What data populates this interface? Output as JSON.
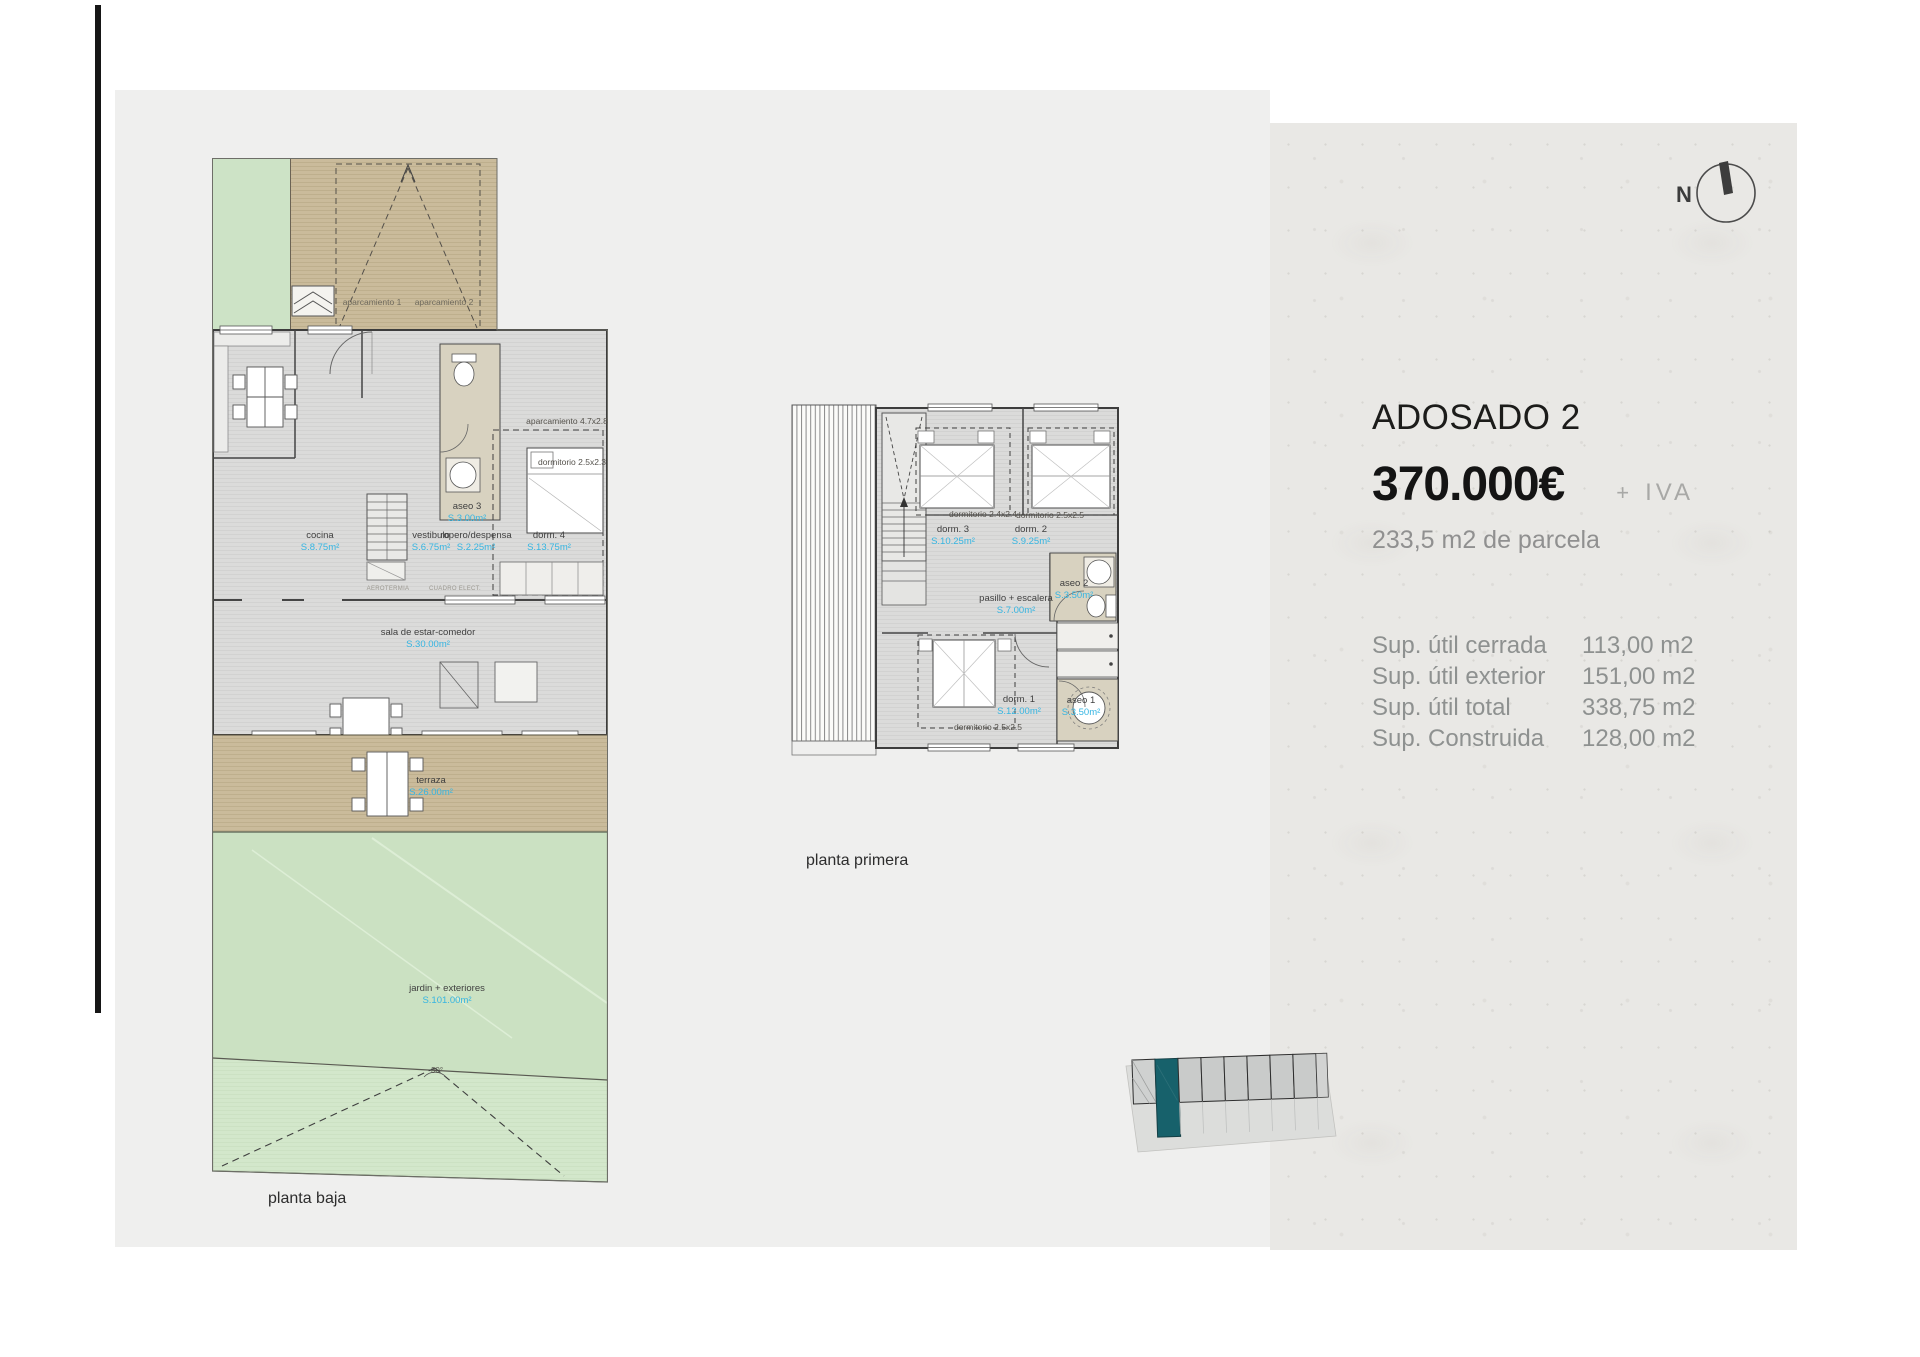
{
  "panel": {
    "title": "ADOSADO 2",
    "price": "370.000€",
    "tax_plus": "+",
    "tax_iva": "IVA",
    "parcel": "233,5 m2 de parcela",
    "surfaces": [
      {
        "label": "Sup. útil cerrada",
        "value": "113,00 m2"
      },
      {
        "label": "Sup. útil exterior",
        "value": "151,00 m2"
      },
      {
        "label": "Sup. útil total",
        "value": "338,75 m2"
      },
      {
        "label": "Sup. Construida",
        "value": "128,00 m2"
      }
    ],
    "compass": "N"
  },
  "floorplans": {
    "planta_baja": {
      "caption": "planta baja",
      "rooms": [
        {
          "name": "cocina",
          "area": "S.8.75m²"
        },
        {
          "name": "vestibulo",
          "area": "S.6.75m²"
        },
        {
          "name": "ropero/despensa",
          "area": "S.2.25m²"
        },
        {
          "name": "dorm. 4",
          "area": "S.13.75m²"
        },
        {
          "name": "aseo 3",
          "area": "S.3.00m²"
        },
        {
          "name": "sala de estar-comedor",
          "area": "S.30.00m²"
        },
        {
          "name": "terraza",
          "area": "S.26.00m²"
        },
        {
          "name": "jardin + exteriores",
          "area": "S.101.00m²"
        }
      ],
      "annotations": {
        "aparcamiento_1": "aparcamiento 1",
        "aparcamiento_2": "aparcamiento 2",
        "aparcamiento_dim": "aparcamiento 4.7x2.8",
        "dormitorio_dim": "dormitorio 2.5x2.3",
        "aerotermia": "AEROTERMIA",
        "cuadro": "CUADRO ELECT.",
        "angle": "30°"
      }
    },
    "planta_primera": {
      "caption": "planta primera",
      "rooms": [
        {
          "name": "dorm. 3",
          "area": "S.10.25m²",
          "dim": "dormitorio 2.4x2.4"
        },
        {
          "name": "dorm. 2",
          "area": "S.9.25m²",
          "dim": "dormitorio 2.5x2.5"
        },
        {
          "name": "pasillo + escalera",
          "area": "S.7.00m²"
        },
        {
          "name": "aseo 2",
          "area": "S.3.50m²"
        },
        {
          "name": "dorm. 1",
          "area": "S.12.00m²",
          "dim": "dormitorio 2.5x2.5"
        },
        {
          "name": "aseo 1",
          "area": "S.3.50m²"
        }
      ]
    }
  },
  "site_plan": {
    "units_count": 8,
    "highlighted_index": 2,
    "highlight_color": "#17616b"
  },
  "colors": {
    "area_label_blue": "#35b5e2",
    "paper": "#e9e8e5",
    "background": "#efefee"
  }
}
